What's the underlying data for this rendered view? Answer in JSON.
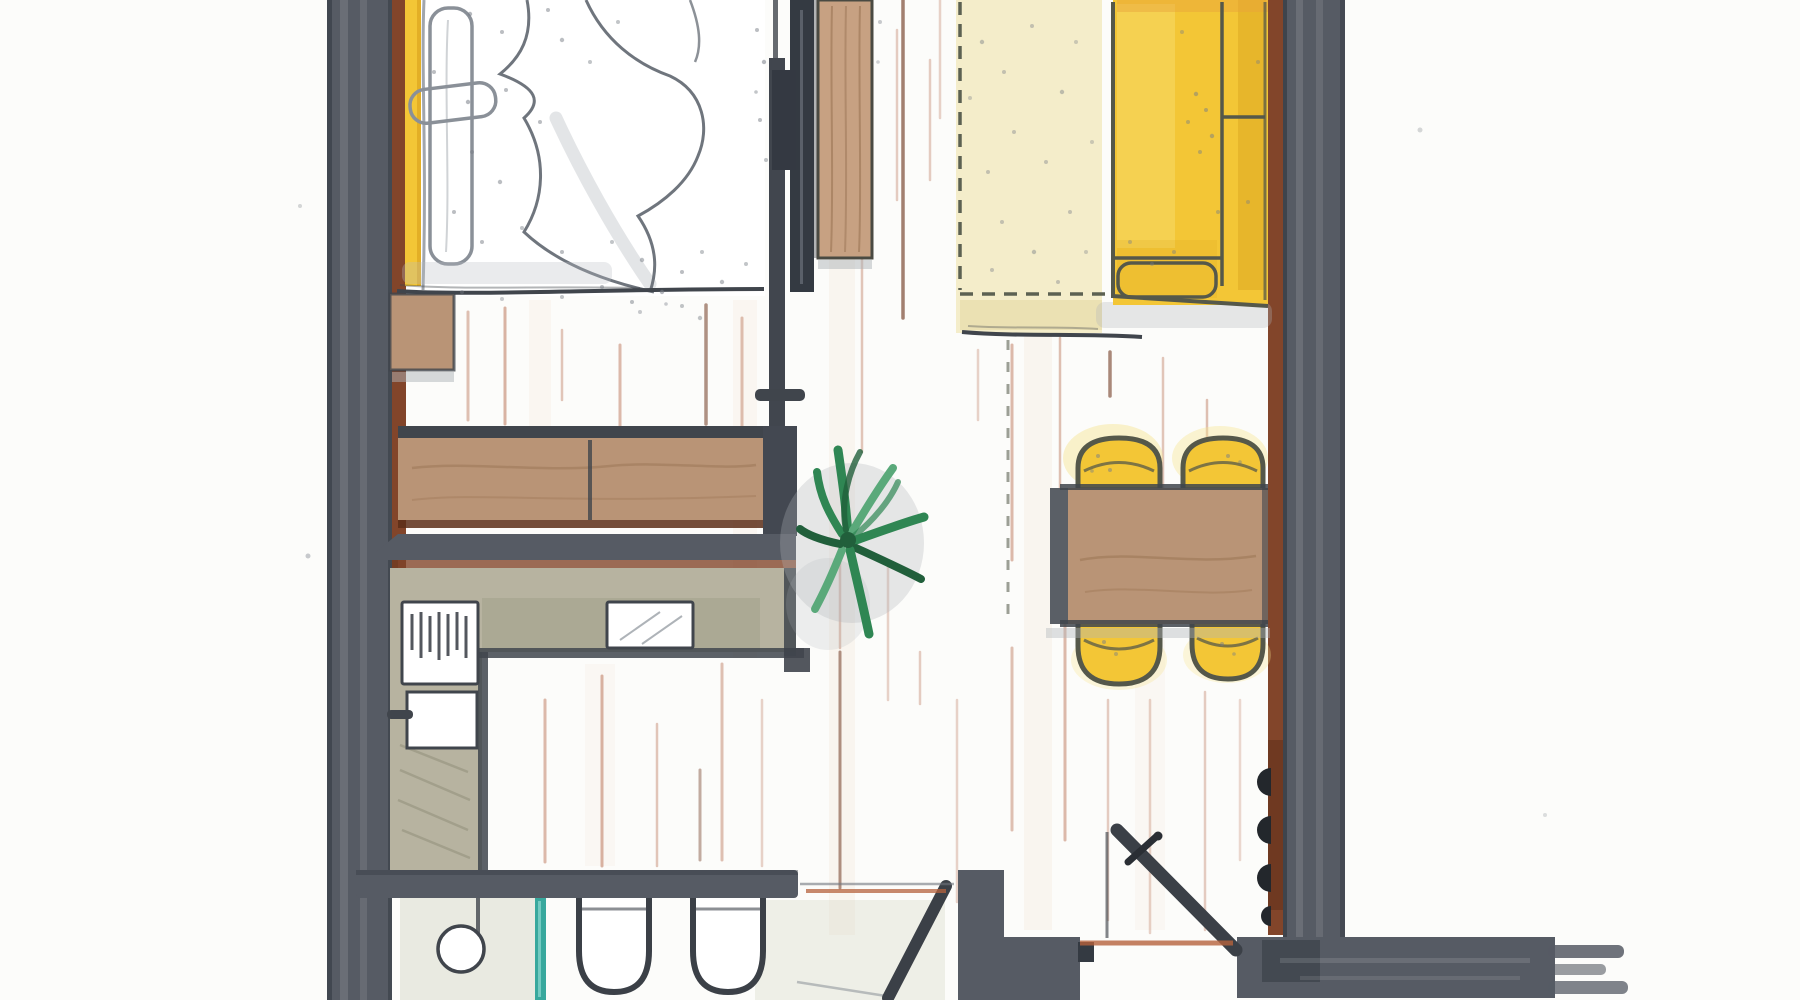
{
  "drawing": {
    "kind": "hand-drawn watercolor floor plan of a studio apartment, top-down view, cropped at top and bottom edges",
    "rooms": [
      "bedroom",
      "open kitchen",
      "living-dining area",
      "bathroom",
      "entry hall"
    ],
    "furniture": [
      "double bed with duvet and pillows",
      "nightstand",
      "wardrobe",
      "sliding door",
      "kitchen sideboard",
      "l-shaped kitchen counter",
      "stove",
      "oven",
      "kitchen sink",
      "washbasin",
      "shower glass panel",
      "two toilets",
      "potted plant",
      "area rug",
      "yellow sofa",
      "dining table",
      "four yellow chairs",
      "entry door",
      "bathroom door",
      "wall hooks"
    ],
    "chair_count": 4,
    "toilet_count": 2
  },
  "palette": {
    "bg": "#fcfcfa",
    "ink": "#40454c",
    "inkSoft": "#6f757d",
    "sketch": "#8a9098",
    "olive": "#55584a",
    "wall": "#565b64",
    "wallDark": "#343a42",
    "hook": "#23272c",
    "brown": "#82452a",
    "brownDark": "#5c2e18",
    "wood": "#b99476",
    "woodLight": "#c7a182",
    "grain": "#9a7453",
    "sage": "#b7b3a0",
    "sageDark": "#a3a08b",
    "sageDeep": "#8e8b76",
    "yellow": "#f3c636",
    "yellowDeep": "#dca51f",
    "yellowPale": "#f8dd74",
    "halo": "#f7e590",
    "orangeTint": "#e8a13b",
    "cream": "#f4edca",
    "creamDeep": "#e8dcab",
    "dashOlive": "#5c6152",
    "teal": "#38a89d",
    "tealLight": "#8fd8d0",
    "green": "#2f8653",
    "greenDark": "#215f3b",
    "greenLight": "#5aa97a",
    "salmon": "#c2836a",
    "streakDark": "#7d4b35",
    "thresholdOrange": "#b5613c",
    "grayWash": "#aeb3b8",
    "floorShade": "#cdcfbc",
    "speck": "#787e86",
    "paleBand": "#eac3a6",
    "white": "#ffffff"
  },
  "floor_washes": [
    [
      842,
      0,
      935,
      26,
      0.12
    ],
    [
      1038,
      330,
      930,
      28,
      0.12
    ],
    [
      745,
      300,
      658,
      24,
      0.1
    ],
    [
      540,
      300,
      428,
      22,
      0.1
    ],
    [
      600,
      664,
      866,
      30,
      0.08
    ],
    [
      1150,
      640,
      930,
      30,
      0.08
    ]
  ],
  "floor_streaks": [
    [
      468,
      312,
      420,
      "s",
      3,
      0.5
    ],
    [
      505,
      308,
      424,
      "s",
      3,
      0.6
    ],
    [
      562,
      330,
      400,
      "s",
      2.5,
      0.45
    ],
    [
      620,
      345,
      426,
      "s",
      3,
      0.55
    ],
    [
      706,
      305,
      424,
      "d",
      3.5,
      0.6
    ],
    [
      742,
      318,
      428,
      "s",
      3,
      0.5
    ],
    [
      545,
      700,
      862,
      "s",
      3,
      0.55
    ],
    [
      602,
      676,
      866,
      "s",
      3,
      0.6
    ],
    [
      657,
      724,
      866,
      "s",
      2.5,
      0.45
    ],
    [
      722,
      664,
      860,
      "s",
      3,
      0.5
    ],
    [
      700,
      770,
      860,
      "d",
      3,
      0.45
    ],
    [
      762,
      700,
      866,
      "s",
      2.5,
      0.35
    ],
    [
      848,
      0,
      210,
      "s",
      3,
      0.55
    ],
    [
      862,
      245,
      452,
      "s",
      2.5,
      0.45
    ],
    [
      897,
      30,
      200,
      "s",
      2.5,
      0.4
    ],
    [
      903,
      0,
      318,
      "d",
      3.5,
      0.7
    ],
    [
      930,
      60,
      180,
      "s",
      2.5,
      0.4
    ],
    [
      940,
      0,
      118,
      "s",
      2.5,
      0.35
    ],
    [
      1012,
      345,
      560,
      "s",
      3,
      0.55
    ],
    [
      1060,
      338,
      520,
      "s",
      2.5,
      0.5
    ],
    [
      1110,
      352,
      396,
      "d",
      3.5,
      0.65
    ],
    [
      1163,
      358,
      500,
      "s",
      2.5,
      0.45
    ],
    [
      1207,
      400,
      492,
      "s",
      2.5,
      0.5
    ],
    [
      978,
      350,
      420,
      "s",
      2.5,
      0.35
    ],
    [
      840,
      560,
      648,
      "s",
      2.5,
      0.45
    ],
    [
      840,
      652,
      888,
      "d",
      3,
      0.6
    ],
    [
      888,
      560,
      700,
      "s",
      2.5,
      0.35
    ],
    [
      1012,
      648,
      830,
      "s",
      3,
      0.5
    ],
    [
      1065,
      620,
      840,
      "s",
      3,
      0.55
    ],
    [
      920,
      652,
      704,
      "s",
      2.5,
      0.4
    ],
    [
      957,
      700,
      902,
      "s",
      2.5,
      0.35
    ],
    [
      1108,
      700,
      920,
      "s",
      2.5,
      0.4
    ],
    [
      1150,
      700,
      933,
      "s",
      2.5,
      0.35
    ],
    [
      1205,
      692,
      930,
      "s",
      2.5,
      0.4
    ],
    [
      1240,
      700,
      860,
      "s",
      2.5,
      0.3
    ]
  ],
  "speckles": [
    [
      470,
      14,
      2.2,
      0.55
    ],
    [
      502,
      32,
      2,
      0.5
    ],
    [
      548,
      10,
      2,
      0.5
    ],
    [
      562,
      40,
      2.2,
      0.5
    ],
    [
      618,
      22,
      2,
      0.45
    ],
    [
      590,
      62,
      2,
      0.45
    ],
    [
      434,
      72,
      2,
      0.5
    ],
    [
      468,
      102,
      2.2,
      0.55
    ],
    [
      506,
      90,
      2,
      0.5
    ],
    [
      540,
      122,
      2,
      0.5
    ],
    [
      472,
      152,
      2,
      0.5
    ],
    [
      500,
      182,
      2.2,
      0.5
    ],
    [
      454,
      212,
      2,
      0.5
    ],
    [
      482,
      242,
      2,
      0.5
    ],
    [
      522,
      228,
      2,
      0.45
    ],
    [
      562,
      252,
      2,
      0.5
    ],
    [
      612,
      242,
      2,
      0.45
    ],
    [
      642,
      260,
      2.2,
      0.5
    ],
    [
      682,
      272,
      2,
      0.5
    ],
    [
      702,
      252,
      2,
      0.45
    ],
    [
      722,
      282,
      2.2,
      0.5
    ],
    [
      746,
      264,
      2,
      0.45
    ],
    [
      602,
      287,
      2,
      0.5
    ],
    [
      662,
      292,
      2.2,
      0.55
    ],
    [
      632,
      302,
      2,
      0.5
    ],
    [
      682,
      306,
      2,
      0.45
    ],
    [
      562,
      297,
      2,
      0.45
    ],
    [
      502,
      299,
      2,
      0.4
    ],
    [
      462,
      292,
      2,
      0.4
    ],
    [
      640,
      312,
      2,
      0.4
    ],
    [
      700,
      318,
      2.2,
      0.45
    ],
    [
      666,
      304,
      1.8,
      0.4
    ],
    [
      757,
      30,
      2,
      0.5
    ],
    [
      764,
      62,
      2.2,
      0.55
    ],
    [
      760,
      120,
      2,
      0.5
    ],
    [
      766,
      160,
      2,
      0.45
    ],
    [
      756,
      92,
      1.8,
      0.45
    ],
    [
      880,
      22,
      2,
      0.4
    ],
    [
      878,
      62,
      1.8,
      0.35
    ],
    [
      1196,
      94,
      2.2,
      0.5
    ],
    [
      1206,
      110,
      2,
      0.5
    ],
    [
      1188,
      122,
      2,
      0.45
    ],
    [
      1212,
      136,
      2.2,
      0.5
    ],
    [
      1200,
      152,
      2,
      0.45
    ],
    [
      1174,
      252,
      2,
      0.45
    ],
    [
      1152,
      264,
      2,
      0.4
    ],
    [
      1130,
      242,
      2,
      0.4
    ],
    [
      1258,
      62,
      2,
      0.4
    ],
    [
      1248,
      202,
      2,
      0.4
    ],
    [
      1182,
      32,
      2,
      0.4
    ],
    [
      1218,
      212,
      2,
      0.45
    ],
    [
      982,
      42,
      2.2,
      0.45
    ],
    [
      1004,
      72,
      2,
      0.4
    ],
    [
      1032,
      26,
      2,
      0.4
    ],
    [
      1062,
      92,
      2.2,
      0.45
    ],
    [
      1014,
      132,
      2,
      0.4
    ],
    [
      988,
      172,
      2,
      0.4
    ],
    [
      1046,
      162,
      2,
      0.4
    ],
    [
      1070,
      212,
      2,
      0.4
    ],
    [
      1002,
      222,
      2,
      0.4
    ],
    [
      1034,
      252,
      2.2,
      0.45
    ],
    [
      992,
      270,
      2,
      0.4
    ],
    [
      1058,
      282,
      2,
      0.4
    ],
    [
      1076,
      42,
      2,
      0.35
    ],
    [
      1092,
      142,
      2,
      0.35
    ],
    [
      970,
      98,
      2,
      0.35
    ],
    [
      1086,
      252,
      2,
      0.35
    ],
    [
      1098,
      456,
      2,
      0.5
    ],
    [
      1110,
      470,
      2,
      0.5
    ],
    [
      1092,
      471,
      1.8,
      0.45
    ],
    [
      1228,
      456,
      2,
      0.5
    ],
    [
      1240,
      462,
      1.8,
      0.45
    ],
    [
      1104,
      642,
      2,
      0.5
    ],
    [
      1116,
      654,
      2,
      0.45
    ],
    [
      1222,
      644,
      2,
      0.5
    ],
    [
      1234,
      654,
      1.8,
      0.45
    ],
    [
      308,
      556,
      2.5,
      0.4
    ],
    [
      300,
      206,
      2,
      0.3
    ],
    [
      1420,
      130,
      2.5,
      0.3
    ],
    [
      1545,
      815,
      2,
      0.25
    ]
  ]
}
